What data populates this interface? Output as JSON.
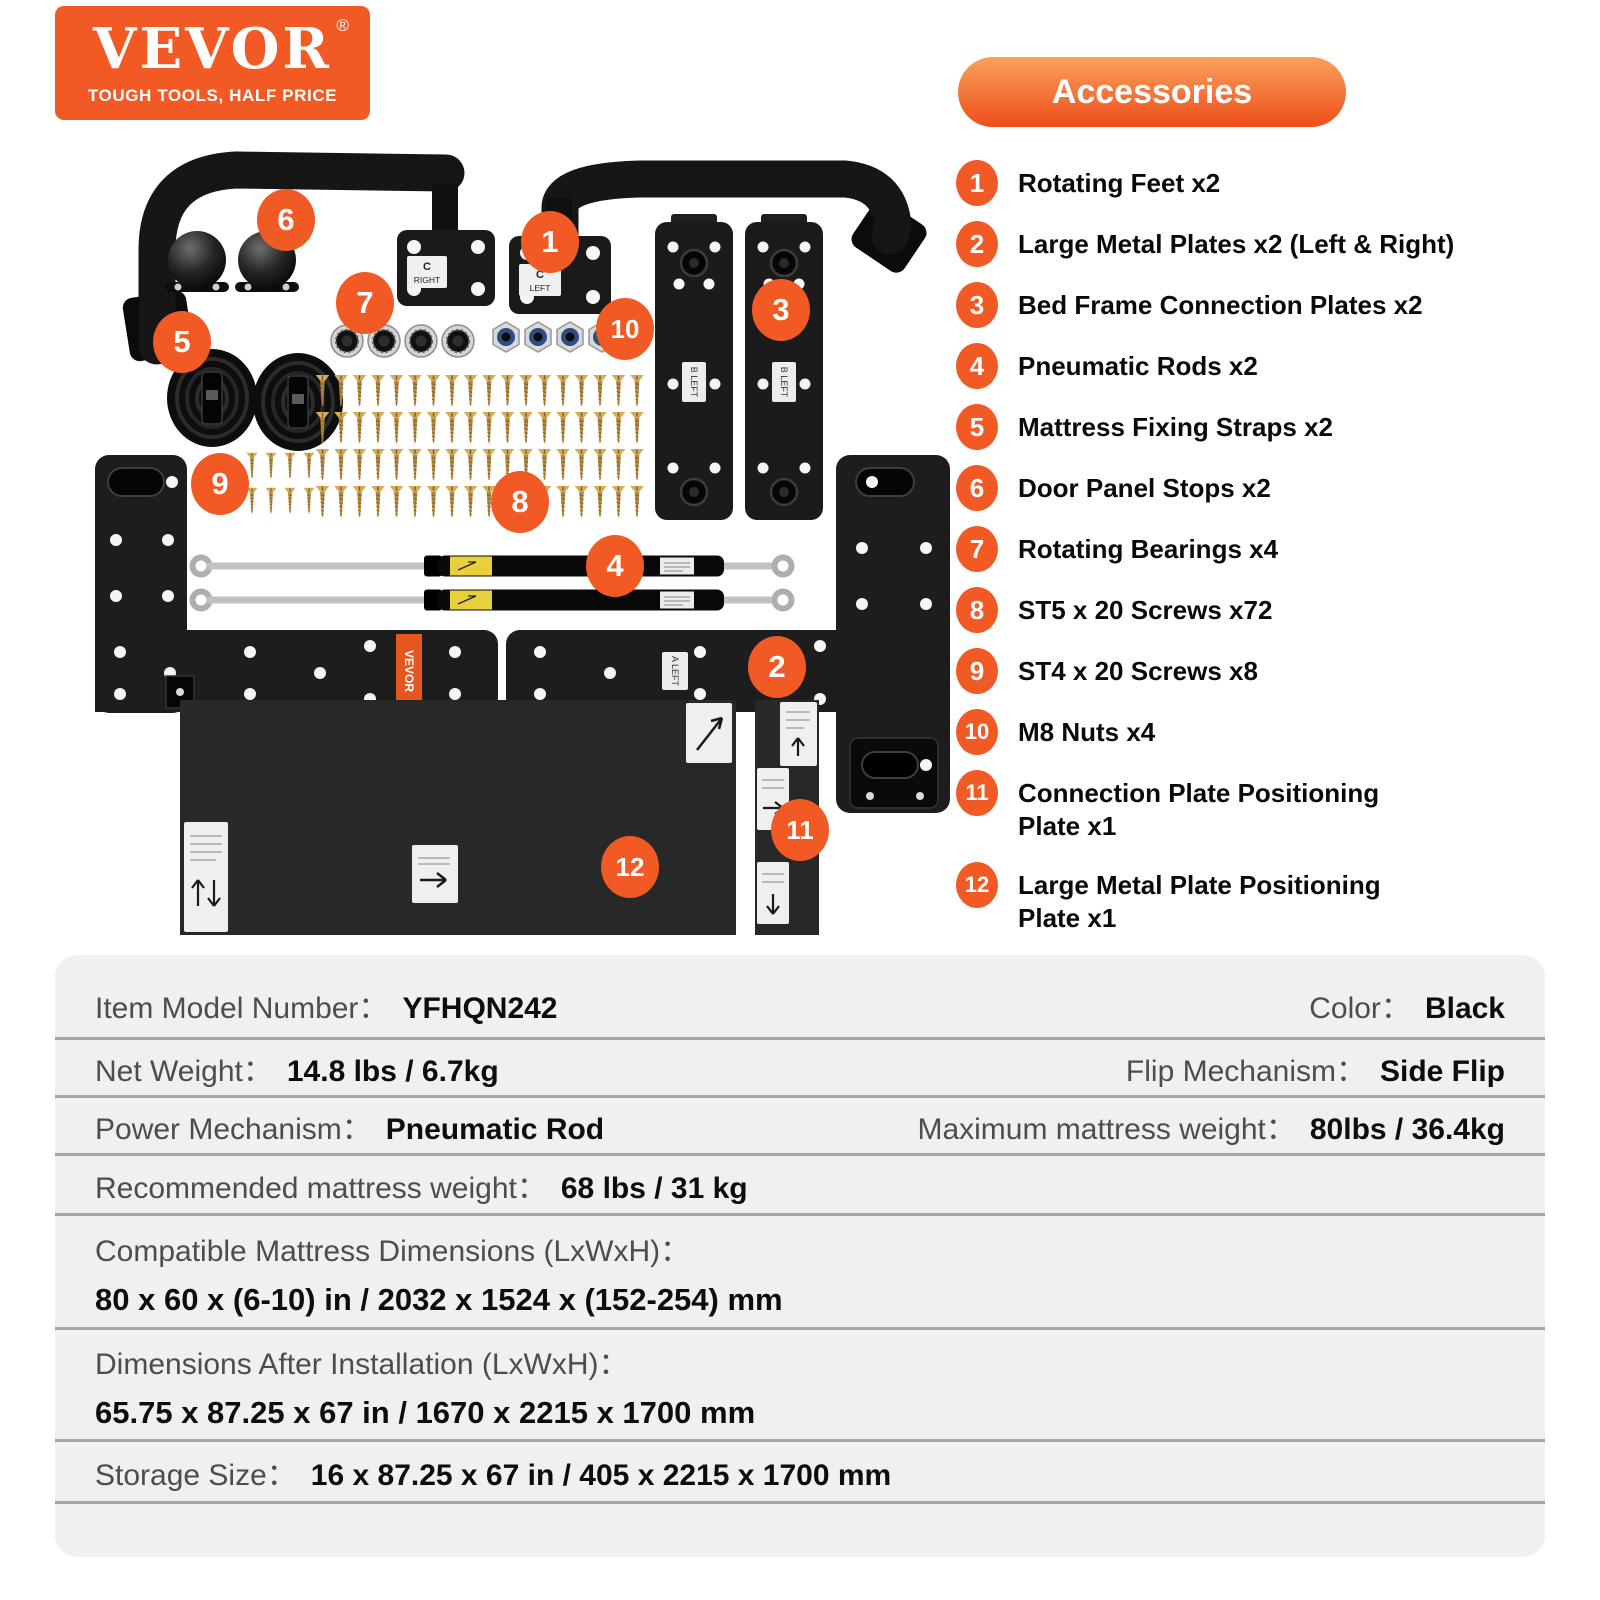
{
  "colors": {
    "brand_orange": "#f15a24",
    "badge_orange": "#f15a24",
    "pill_gradient_top": "#f9a25c",
    "pill_gradient_bottom": "#ee4e1b",
    "table_background": "#f0f0f0",
    "table_separator": "#a6a6a6",
    "table_label_gray": "#4d4d4d",
    "table_value_black": "#0d0d0d"
  },
  "brand": {
    "logo_text": "VEVOR",
    "registered_mark": "®",
    "tagline": "TOUGH TOOLS, HALF PRICE"
  },
  "accessories_panel": {
    "title": "Accessories",
    "items": [
      {
        "num": "1",
        "label": "Rotating Feet x2"
      },
      {
        "num": "2",
        "label": "Large Metal Plates x2 (Left & Right)"
      },
      {
        "num": "3",
        "label": "Bed Frame Connection Plates x2"
      },
      {
        "num": "4",
        "label": "Pneumatic Rods x2"
      },
      {
        "num": "5",
        "label": "Mattress Fixing Straps x2"
      },
      {
        "num": "6",
        "label": "Door Panel Stops x2"
      },
      {
        "num": "7",
        "label": "Rotating Bearings x4"
      },
      {
        "num": "8",
        "label": "ST5 x 20 Screws x72"
      },
      {
        "num": "9",
        "label": "ST4 x 20 Screws x8"
      },
      {
        "num": "10",
        "label": "M8 Nuts x4"
      },
      {
        "num": "11",
        "label": "Connection Plate Positioning",
        "label2": "Plate x1"
      },
      {
        "num": "12",
        "label": "Large Metal Plate Positioning",
        "label2": "Plate x1"
      }
    ]
  },
  "image_badges": [
    {
      "num": "1",
      "left": 466,
      "top": 81
    },
    {
      "num": "2",
      "left": 693,
      "top": 506
    },
    {
      "num": "3",
      "left": 697,
      "top": 149
    },
    {
      "num": "4",
      "left": 531,
      "top": 405
    },
    {
      "num": "5",
      "left": 98,
      "top": 181
    },
    {
      "num": "6",
      "left": 202,
      "top": 59
    },
    {
      "num": "7",
      "left": 281,
      "top": 142
    },
    {
      "num": "8",
      "left": 436,
      "top": 341
    },
    {
      "num": "9",
      "left": 136,
      "top": 323
    },
    {
      "num": "10",
      "left": 541,
      "top": 168
    },
    {
      "num": "11",
      "left": 716,
      "top": 669
    },
    {
      "num": "12",
      "left": 546,
      "top": 706
    }
  ],
  "part_labels": {
    "bracket_right_line1": "C",
    "bracket_right_line2": "RIGHT",
    "bracket_left_line1": "C",
    "bracket_left_line2": "LEFT",
    "connection_plate_label": "B LEFT",
    "large_plate_label": "A LEFT",
    "side_logo_label": "VEVOR"
  },
  "hardware": {
    "st5_screw_count": 72,
    "st4_screw_count": 8,
    "m8_nut_count": 4,
    "bearing_count": 4
  },
  "spec_table": {
    "rows": [
      {
        "type": "pair2",
        "left": {
          "label": "Item Model Number：",
          "value": "YFHQN242"
        },
        "right": {
          "label": "Color：",
          "value": "Black"
        }
      },
      {
        "type": "pair2",
        "left": {
          "label": "Net Weight：",
          "value": "14.8 lbs / 6.7kg"
        },
        "right": {
          "label": "Flip Mechanism：",
          "value": "Side Flip"
        }
      },
      {
        "type": "pair2",
        "left": {
          "label": "Power Mechanism：",
          "value": "Pneumatic Rod"
        },
        "right": {
          "label": "Maximum mattress weight：",
          "value": "80lbs / 36.4kg"
        }
      },
      {
        "type": "pair1",
        "left": {
          "label": "Recommended mattress weight：",
          "value": "68 lbs / 31 kg"
        }
      },
      {
        "type": "stacked",
        "left": {
          "label": "Compatible Mattress Dimensions (LxWxH)：",
          "value": "80 x 60 x (6-10) in / 2032 x 1524 x (152-254) mm"
        }
      },
      {
        "type": "stacked",
        "left": {
          "label": "Dimensions After Installation (LxWxH)：",
          "value": "65.75 x 87.25 x 67 in / 1670 x 2215 x 1700 mm"
        }
      },
      {
        "type": "pair1",
        "left": {
          "label": "Storage Size：",
          "value": "16 x 87.25 x 67 in / 405 x 2215 x 1700 mm"
        }
      }
    ]
  }
}
